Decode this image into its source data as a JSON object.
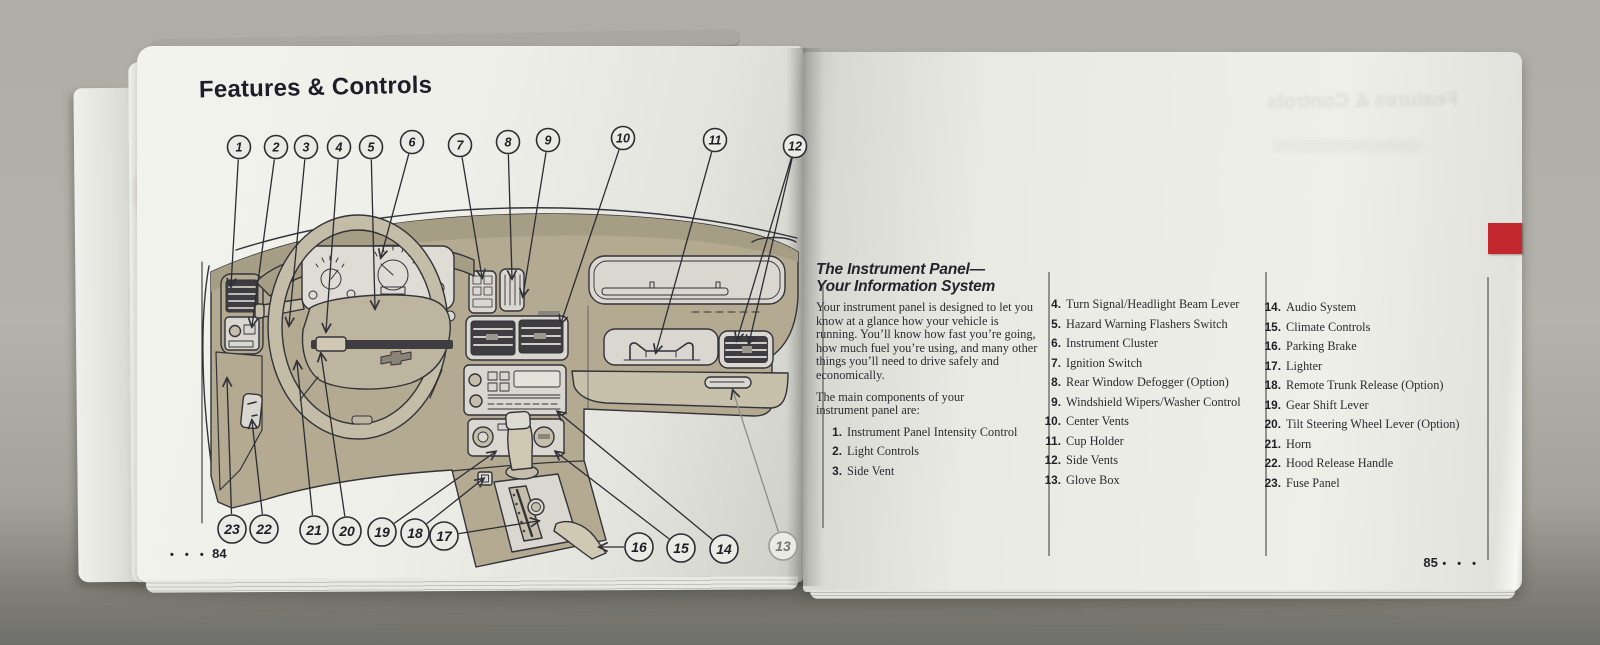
{
  "book": {
    "left_page": {
      "title": "Features & Controls",
      "page_number": "84",
      "page_dots": "• • •",
      "diagram": {
        "description": "instrument-panel-line-drawing",
        "callouts_top": [
          "1",
          "2",
          "3",
          "4",
          "5",
          "6",
          "7",
          "8",
          "9",
          "10",
          "11",
          "12"
        ],
        "callouts_bottom": [
          "23",
          "22",
          "21",
          "20",
          "19",
          "18",
          "17",
          "16",
          "15",
          "14",
          "13"
        ]
      }
    },
    "right_page": {
      "heading_line1": "The Instrument Panel—",
      "heading_line2": "Your Information System",
      "intro": "Your instrument panel is designed to let you know at a glance how your vehicle is running. You’ll know how fast you’re going, how much fuel you’re using, and many other things you’ll need to drive safely and economically.",
      "intro2": "The main components of your instrument panel are:",
      "items": [
        {
          "num": "1.",
          "label": "Instrument Panel Intensity Control"
        },
        {
          "num": "2.",
          "label": "Light Controls"
        },
        {
          "num": "3.",
          "label": "Side Vent"
        },
        {
          "num": "4.",
          "label": "Turn Signal/Headlight Beam Lever"
        },
        {
          "num": "5.",
          "label": "Hazard Warning Flashers Switch"
        },
        {
          "num": "6.",
          "label": "Instrument Cluster"
        },
        {
          "num": "7.",
          "label": "Ignition Switch"
        },
        {
          "num": "8.",
          "label": "Rear Window Defogger (Option)"
        },
        {
          "num": "9.",
          "label": "Windshield Wipers/Washer Control"
        },
        {
          "num": "10.",
          "label": "Center Vents"
        },
        {
          "num": "11.",
          "label": "Cup Holder"
        },
        {
          "num": "12.",
          "label": "Side Vents"
        },
        {
          "num": "13.",
          "label": "Glove Box"
        },
        {
          "num": "14.",
          "label": "Audio System"
        },
        {
          "num": "15.",
          "label": "Climate Controls"
        },
        {
          "num": "16.",
          "label": "Parking Brake"
        },
        {
          "num": "17.",
          "label": "Lighter"
        },
        {
          "num": "18.",
          "label": "Remote Trunk Release (Option)"
        },
        {
          "num": "19.",
          "label": "Gear Shift Lever"
        },
        {
          "num": "20.",
          "label": "Tilt Steering Wheel Lever (Option)"
        },
        {
          "num": "21.",
          "label": "Horn"
        },
        {
          "num": "22.",
          "label": "Hood Release Handle"
        },
        {
          "num": "23.",
          "label": "Fuse Panel"
        }
      ],
      "page_number": "85",
      "page_dots": "• • •",
      "tab_color": "#c3282e"
    },
    "colors": {
      "dash_tan": "#b3aa91",
      "page_white": "#efefe9",
      "ink": "#33333a"
    }
  }
}
